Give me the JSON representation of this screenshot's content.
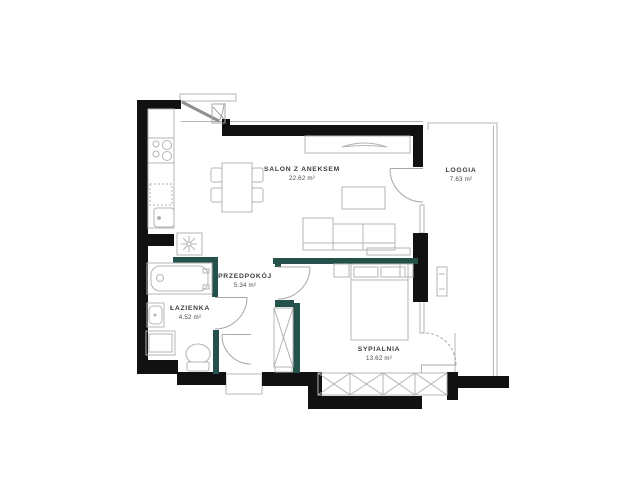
{
  "plan": {
    "title": "Apartment floor plan",
    "rooms": [
      {
        "id": "salon",
        "name": "SALON Z ANEKSEM",
        "area": "22.62 m²"
      },
      {
        "id": "loggia",
        "name": "LOGGIA",
        "area": "7.63 m²"
      },
      {
        "id": "przedpokoj",
        "name": "PRZEDPOKÓJ",
        "area": "5.34 m²"
      },
      {
        "id": "lazienka",
        "name": "ŁAZIENKA",
        "area": "4.52 m²"
      },
      {
        "id": "sypialnia",
        "name": "SYPIALNIA",
        "area": "13.62 m²"
      }
    ],
    "colors": {
      "wall": "#111111",
      "accent_wall": "#24524a",
      "line": "#b4b4b4",
      "door_line": "#a7a7a7",
      "text": "#3d3d3d"
    }
  }
}
